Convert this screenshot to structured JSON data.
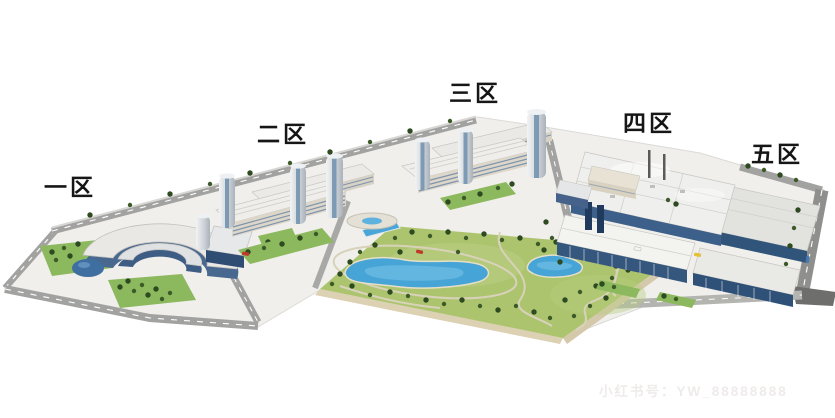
{
  "illustration": {
    "name": "campus-aerial-3d-render"
  },
  "zones": [
    {
      "id": "zone-1",
      "label": "一区"
    },
    {
      "id": "zone-2",
      "label": "二区"
    },
    {
      "id": "zone-3",
      "label": "三区"
    },
    {
      "id": "zone-4",
      "label": "四区"
    },
    {
      "id": "zone-5",
      "label": "五区"
    }
  ],
  "watermark": {
    "label": "小红书号：YW_88888888"
  },
  "colors": {
    "background": "#ffffff",
    "grass": "#adc46f",
    "lawn": "#8cb85e",
    "lake": "#46a4d6",
    "road": "#a2a2a0",
    "road_dark": "#6e6e6c",
    "roof_light": "#efefed",
    "facade_blue": "#3c6089",
    "facade_deep": "#2f5178",
    "tree": "#2e4a21",
    "park_edge": "#ddd1b4",
    "label_color": "#161616",
    "watermark_color": "#eeebea"
  }
}
